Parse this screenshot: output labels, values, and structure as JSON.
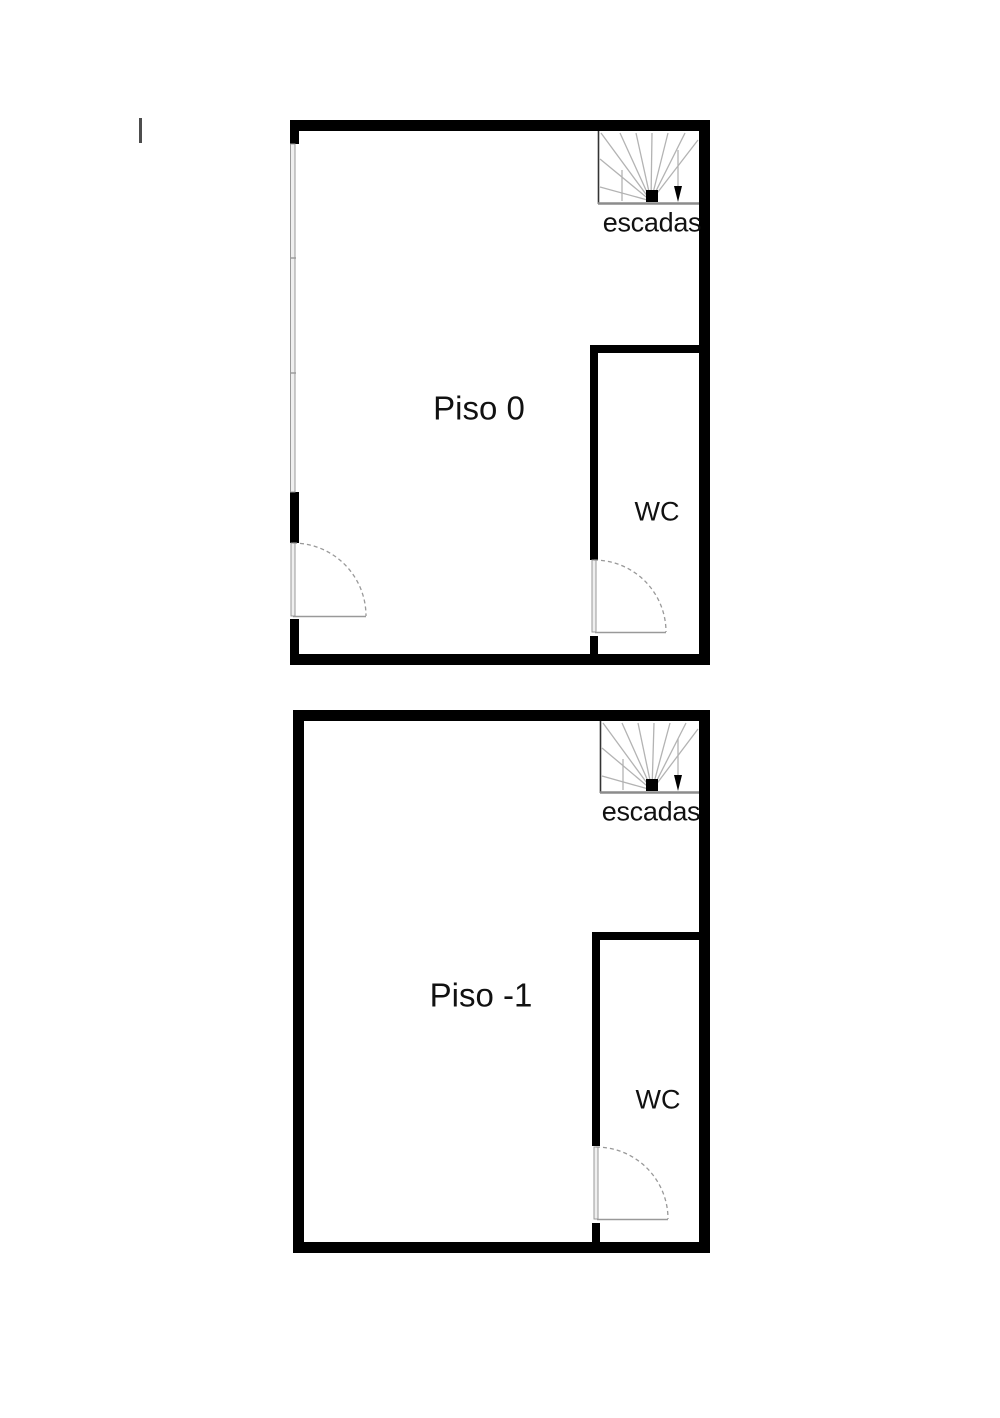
{
  "page": {
    "background": "#ffffff",
    "description_type": "floor-plan"
  },
  "colors": {
    "background": "#ffffff",
    "wall": "#000000",
    "thin": "#999999",
    "window_fill": "#efefef",
    "stairs_line": "#b3b3b3",
    "tick": "#4d4d4d",
    "text": "#111111"
  },
  "plans": [
    {
      "title": "Piso 0",
      "wc_label": "WC",
      "stairs_label": "escadas"
    },
    {
      "title": "Piso -1",
      "wc_label": "WC",
      "stairs_label": "escadas"
    }
  ]
}
